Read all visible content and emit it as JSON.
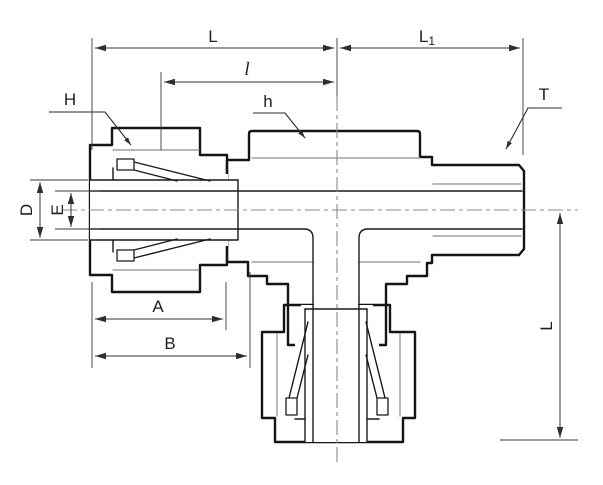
{
  "drawing": {
    "type": "technical-drawing",
    "subject": "compression tube fitting male run tee cross-section",
    "colors": {
      "outline": "#141414",
      "dimension_lines": "#333333",
      "body_fill": "#eaeaea",
      "nut_fill": "#dedede",
      "centerline": "#8a8a8a",
      "background": "#ffffff"
    },
    "labels": {
      "L": "L",
      "l": "l",
      "L1": {
        "base": "L",
        "sub": "1"
      },
      "H": "H",
      "h": "h",
      "T": "T",
      "D": "D",
      "E": "E",
      "A": "A",
      "B": "B",
      "L_vertical": "L"
    }
  }
}
